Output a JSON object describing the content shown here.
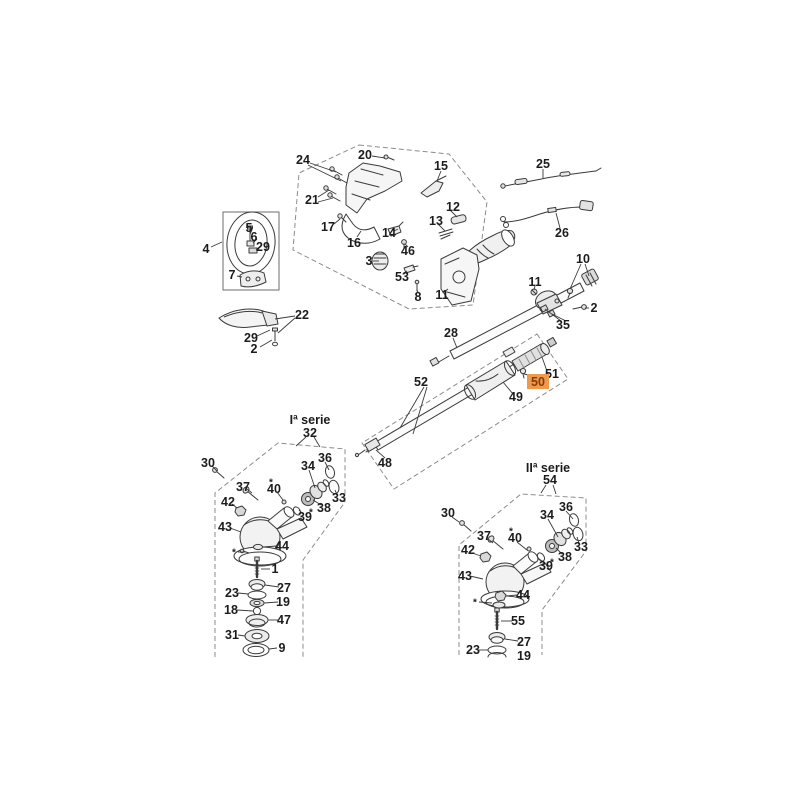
{
  "meta": {
    "description": "Exploded spare-parts diagram of a brushcutter / grass trimmer (handle, throttle, drive shaft and two bevel-gear series)",
    "canvas": {
      "width": 800,
      "height": 800
    },
    "background": "#ffffff"
  },
  "style": {
    "line_color": "#3b3b3b",
    "outline_color": "#8c8c8c",
    "label_color": "#1c1c1c",
    "highlight_bg": "#ee9a4e",
    "highlight_text": "#8a3c00"
  },
  "diagram": {
    "selected_part": "50",
    "series": [
      {
        "id": "serie1",
        "title": "Iª serie"
      },
      {
        "id": "serie2",
        "title": "IIª serie"
      }
    ],
    "labels": [
      {
        "id": "24",
        "t": "24",
        "x": 303,
        "y": 160
      },
      {
        "id": "20",
        "t": "20",
        "x": 365,
        "y": 155
      },
      {
        "id": "15",
        "t": "15",
        "x": 441,
        "y": 166
      },
      {
        "id": "21",
        "t": "21",
        "x": 312,
        "y": 200
      },
      {
        "id": "17",
        "t": "17",
        "x": 328,
        "y": 227
      },
      {
        "id": "16",
        "t": "16",
        "x": 354,
        "y": 243
      },
      {
        "id": "14",
        "t": "14",
        "x": 389,
        "y": 233
      },
      {
        "id": "46",
        "t": "46",
        "x": 408,
        "y": 251
      },
      {
        "id": "12",
        "t": "12",
        "x": 453,
        "y": 207
      },
      {
        "id": "13",
        "t": "13",
        "x": 436,
        "y": 221
      },
      {
        "id": "3",
        "t": "3",
        "x": 369,
        "y": 261
      },
      {
        "id": "53",
        "t": "53",
        "x": 402,
        "y": 277
      },
      {
        "id": "8",
        "t": "8",
        "x": 418,
        "y": 297
      },
      {
        "id": "11-throttle",
        "t": "11",
        "x": 442,
        "y": 295
      },
      {
        "id": "25",
        "t": "25",
        "x": 543,
        "y": 164
      },
      {
        "id": "26",
        "t": "26",
        "x": 562,
        "y": 233
      },
      {
        "id": "4",
        "t": "4",
        "x": 206,
        "y": 249
      },
      {
        "id": "5",
        "t": "5",
        "x": 249,
        "y": 228
      },
      {
        "id": "6",
        "t": "6",
        "x": 254,
        "y": 237
      },
      {
        "id": "29-handle",
        "t": "29",
        "x": 263,
        "y": 247
      },
      {
        "id": "7",
        "t": "7",
        "x": 232,
        "y": 275
      },
      {
        "id": "22",
        "t": "22",
        "x": 302,
        "y": 315
      },
      {
        "id": "29-guard",
        "t": "29",
        "x": 251,
        "y": 338
      },
      {
        "id": "2-guard",
        "t": "2",
        "x": 254,
        "y": 349
      },
      {
        "id": "10",
        "t": "10",
        "x": 583,
        "y": 259
      },
      {
        "id": "11-clamp",
        "t": "11",
        "x": 535,
        "y": 282
      },
      {
        "id": "2-clamp",
        "t": "2",
        "x": 594,
        "y": 308
      },
      {
        "id": "35",
        "t": "35",
        "x": 563,
        "y": 325
      },
      {
        "id": "28",
        "t": "28",
        "x": 451,
        "y": 333
      },
      {
        "id": "52",
        "t": "52",
        "x": 421,
        "y": 382
      },
      {
        "id": "51",
        "t": "51",
        "x": 552,
        "y": 374
      },
      {
        "id": "50",
        "t": "50",
        "x": 538,
        "y": 382,
        "hl": true
      },
      {
        "id": "49",
        "t": "49",
        "x": 516,
        "y": 397
      },
      {
        "id": "48",
        "t": "48",
        "x": 385,
        "y": 463
      },
      {
        "id": "serie1",
        "t": "Iª serie",
        "x": 310,
        "y": 420,
        "kind": "title"
      },
      {
        "id": "32",
        "t": "32",
        "x": 310,
        "y": 433
      },
      {
        "id": "30-s1",
        "t": "30",
        "x": 208,
        "y": 463
      },
      {
        "id": "36-s1",
        "t": "36",
        "x": 325,
        "y": 458
      },
      {
        "id": "34-s1",
        "t": "34",
        "x": 308,
        "y": 466
      },
      {
        "id": "37-s1",
        "t": "37",
        "x": 243,
        "y": 487
      },
      {
        "id": "40-s1",
        "t": "40",
        "x": 274,
        "y": 489
      },
      {
        "id": "42-s1",
        "t": "42",
        "x": 228,
        "y": 502
      },
      {
        "id": "33-s1",
        "t": "33",
        "x": 339,
        "y": 498
      },
      {
        "id": "38-s1",
        "t": "38",
        "x": 324,
        "y": 508
      },
      {
        "id": "39-s1",
        "t": "39",
        "x": 305,
        "y": 517
      },
      {
        "id": "43-s1",
        "t": "43",
        "x": 225,
        "y": 527
      },
      {
        "id": "44-s1",
        "t": "44",
        "x": 282,
        "y": 546
      },
      {
        "id": "1",
        "t": "1",
        "x": 275,
        "y": 569
      },
      {
        "id": "27-s1",
        "t": "27",
        "x": 284,
        "y": 588
      },
      {
        "id": "23-s1",
        "t": "23",
        "x": 232,
        "y": 593
      },
      {
        "id": "19-s1",
        "t": "19",
        "x": 283,
        "y": 602
      },
      {
        "id": "18",
        "t": "18",
        "x": 231,
        "y": 610
      },
      {
        "id": "47",
        "t": "47",
        "x": 284,
        "y": 620
      },
      {
        "id": "31",
        "t": "31",
        "x": 232,
        "y": 635
      },
      {
        "id": "9",
        "t": "9",
        "x": 282,
        "y": 648
      },
      {
        "id": "serie2",
        "t": "IIª serie",
        "x": 548,
        "y": 468,
        "kind": "title"
      },
      {
        "id": "54",
        "t": "54",
        "x": 550,
        "y": 480
      },
      {
        "id": "30-s2",
        "t": "30",
        "x": 448,
        "y": 513
      },
      {
        "id": "36-s2",
        "t": "36",
        "x": 566,
        "y": 507
      },
      {
        "id": "34-s2",
        "t": "34",
        "x": 547,
        "y": 515
      },
      {
        "id": "37-s2",
        "t": "37",
        "x": 484,
        "y": 536
      },
      {
        "id": "40-s2",
        "t": "40",
        "x": 515,
        "y": 538
      },
      {
        "id": "42-s2",
        "t": "42",
        "x": 468,
        "y": 550
      },
      {
        "id": "33-s2",
        "t": "33",
        "x": 581,
        "y": 547
      },
      {
        "id": "38-s2",
        "t": "38",
        "x": 565,
        "y": 557
      },
      {
        "id": "39-s2",
        "t": "39",
        "x": 546,
        "y": 566
      },
      {
        "id": "43-s2",
        "t": "43",
        "x": 465,
        "y": 576
      },
      {
        "id": "44-s2",
        "t": "44",
        "x": 523,
        "y": 595
      },
      {
        "id": "55",
        "t": "55",
        "x": 518,
        "y": 621
      },
      {
        "id": "27-s2",
        "t": "27",
        "x": 524,
        "y": 642
      },
      {
        "id": "23-s2",
        "t": "23",
        "x": 473,
        "y": 650
      },
      {
        "id": "19-s2",
        "t": "19",
        "x": 524,
        "y": 656
      },
      {
        "id": "mark-40-s1",
        "t": "*",
        "x": 271,
        "y": 483,
        "kind": "mark"
      },
      {
        "id": "mark-39-s1",
        "t": "*",
        "x": 311,
        "y": 513,
        "kind": "mark"
      },
      {
        "id": "mark-44-s1",
        "t": "*",
        "x": 234,
        "y": 553,
        "kind": "mark"
      },
      {
        "id": "mark-40-s2",
        "t": "*",
        "x": 511,
        "y": 532,
        "kind": "mark"
      },
      {
        "id": "mark-39-s2",
        "t": "*",
        "x": 552,
        "y": 563,
        "kind": "mark"
      },
      {
        "id": "mark-washer-s2",
        "t": "*",
        "x": 475,
        "y": 603,
        "kind": "mark"
      }
    ]
  }
}
